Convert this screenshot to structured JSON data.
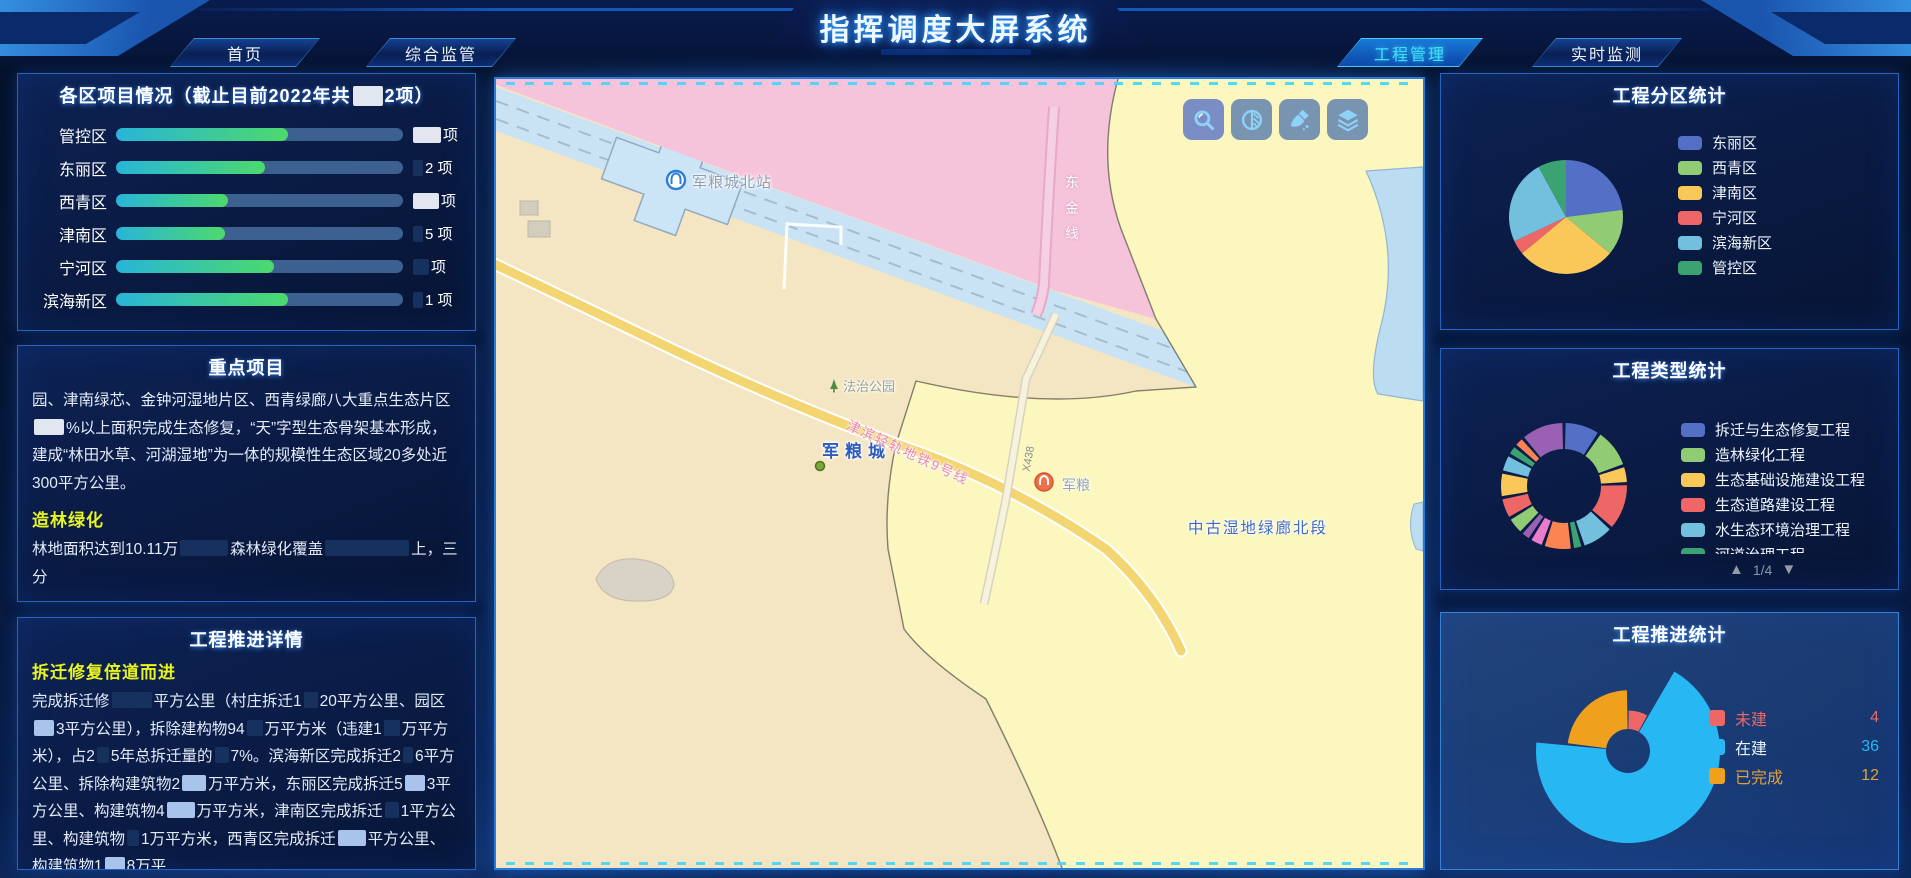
{
  "header": {
    "title": "指挥调度大屏系统",
    "tabs": [
      {
        "label": "首页",
        "active": false
      },
      {
        "label": "综合监管",
        "active": false
      },
      {
        "label": "工程管理",
        "active": true
      },
      {
        "label": "实时监测",
        "active": false
      }
    ]
  },
  "colors": {
    "accent_cyan": "#3fe3ff",
    "subhead_yellow": "#e9f520",
    "bar_gradient_start": "#28b5d8",
    "bar_gradient_end": "#4cd96d",
    "bar_track": "#3c6191",
    "panel_border": "#2a62c0"
  },
  "panels": {
    "district": {
      "title_segments": [
        {
          "t": "各区项目情况（截止目前2022年共"
        },
        {
          "r": "light",
          "w": 30
        },
        {
          "t": "2项）"
        }
      ],
      "rows": [
        {
          "label": "管控区",
          "percent": 60,
          "value_segments": [
            {
              "r": "light",
              "w": 28
            },
            {
              "t": "项"
            }
          ]
        },
        {
          "label": "东丽区",
          "percent": 52,
          "value_segments": [
            {
              "r": "dark",
              "w": 10
            },
            {
              "t": "2 项"
            }
          ]
        },
        {
          "label": "西青区",
          "percent": 39,
          "value_segments": [
            {
              "r": "light",
              "w": 26
            },
            {
              "t": "项"
            }
          ]
        },
        {
          "label": "津南区",
          "percent": 38,
          "value_segments": [
            {
              "r": "dark",
              "w": 10
            },
            {
              "t": "5 项"
            }
          ]
        },
        {
          "label": "宁河区",
          "percent": 55,
          "value_segments": [
            {
              "r": "dark",
              "w": 16
            },
            {
              "t": "项"
            }
          ]
        },
        {
          "label": "滨海新区",
          "percent": 60,
          "value_segments": [
            {
              "r": "dark",
              "w": 10
            },
            {
              "t": "1 项"
            }
          ]
        }
      ]
    },
    "key_projects": {
      "title": "重点项目",
      "p1_segments": [
        {
          "t": "园、津南绿芯、金钟河湿地片区、西青绿廊八大重点生态片区"
        },
        {
          "r": "light",
          "w": 30
        },
        {
          "t": "%以上面积完成生态修复，“天”字型生态骨架基本形成，建成“林田水草、河湖湿地”为一体的规模性生态区域20多处近300平方公里。"
        }
      ],
      "subhead": "造林绿化",
      "p2_segments": [
        {
          "t": "林地面积达到10.11万"
        },
        {
          "r": "dark",
          "w": 48
        },
        {
          "t": "森林绿化覆盖"
        },
        {
          "r": "dark",
          "w": 84
        },
        {
          "t": "上，三分"
        }
      ]
    },
    "progress_detail": {
      "title": "工程推进详情",
      "subhead": "拆迁修复倍道而进",
      "p_segments": [
        {
          "t": "完成拆迁修"
        },
        {
          "r": "dark",
          "w": 40
        },
        {
          "t": "平方公里（村庄拆迁1"
        },
        {
          "r": "dark",
          "w": 14
        },
        {
          "t": "20平方公里、园区"
        },
        {
          "r": "mid",
          "w": 20
        },
        {
          "t": "3平方公里），拆除建构物94"
        },
        {
          "r": "dark",
          "w": 16
        },
        {
          "t": "万平方米（违建1"
        },
        {
          "r": "dark",
          "w": 16
        },
        {
          "t": "万平方米），占2"
        },
        {
          "r": "dark",
          "w": 12
        },
        {
          "t": "5年总拆迁量的"
        },
        {
          "r": "dark",
          "w": 14
        },
        {
          "t": "7%。滨海新区完成拆迁2"
        },
        {
          "r": "dark",
          "w": 10
        },
        {
          "t": "6平方公里、拆除构建筑物2"
        },
        {
          "r": "mid",
          "w": 24
        },
        {
          "t": "万平方米，东丽区完成拆迁5"
        },
        {
          "r": "mid",
          "w": 20
        },
        {
          "t": "3平方公里、构建筑物4"
        },
        {
          "r": "mid",
          "w": 28
        },
        {
          "t": "万平方米，津南区完成拆迁"
        },
        {
          "r": "dark",
          "w": 14
        },
        {
          "t": "1平方公里、构建筑物"
        },
        {
          "r": "dark",
          "w": 12
        },
        {
          "t": "1万平方米，西青区完成拆迁"
        },
        {
          "r": "mid",
          "w": 28
        },
        {
          "t": "平方公里、构建筑物1"
        },
        {
          "r": "mid",
          "w": 20
        },
        {
          "t": "8万平"
        }
      ]
    },
    "zone_stats": {
      "title": "工程分区统计"
    },
    "type_stats": {
      "title": "工程类型统计",
      "pagination": "1/4",
      "page_up_icon": "▲",
      "page_down_icon": "▼"
    },
    "push_stats": {
      "title": "工程推进统计"
    }
  },
  "map": {
    "labels": {
      "station_north": "军粮城北站",
      "park": "法治公园",
      "town": "军粮城",
      "rail_line": "津滨轻轨地铁9号线",
      "road_code": "X438",
      "line_east": "东金线",
      "corridor": "中古湿地绿廊北段",
      "station_right": "军粮"
    },
    "toolbar": [
      {
        "name": "zoom-tool"
      },
      {
        "name": "contrast-tool"
      },
      {
        "name": "clean-tool"
      },
      {
        "name": "layers-tool"
      }
    ],
    "region_colors": {
      "tan": "#f5e6c3",
      "pink": "#f6c4da",
      "rail_band": "#c9e3f5",
      "yellow": "#fbf7be",
      "water": "#bcdcf2",
      "road": "#f3d571"
    }
  },
  "chart_data": [
    {
      "id": "district_bars",
      "type": "bar",
      "title": "各区项目情况（截止目前2022年共█2项）",
      "categories": [
        "管控区",
        "东丽区",
        "西青区",
        "津南区",
        "宁河区",
        "滨海新区"
      ],
      "fill_percent": [
        60,
        52,
        39,
        38,
        55,
        60
      ],
      "values_visible": [
        "",
        "2",
        "",
        "5",
        "",
        "1"
      ],
      "unit": "项"
    },
    {
      "id": "zone_pie",
      "type": "pie",
      "title": "工程分区统计",
      "categories": [
        "东丽区",
        "西青区",
        "津南区",
        "宁河区",
        "滨海新区",
        "管控区"
      ],
      "values": [
        23,
        13,
        28,
        4,
        24,
        8
      ],
      "colors": [
        "#5470c6",
        "#91cc75",
        "#fac858",
        "#ee6666",
        "#73c0de",
        "#3ba272"
      ],
      "legend_position": "right"
    },
    {
      "id": "type_donut",
      "type": "pie",
      "title": "工程类型统计",
      "legend": [
        {
          "label": "拆迁与生态修复工程",
          "color": "#5470c6"
        },
        {
          "label": "造林绿化工程",
          "color": "#91cc75"
        },
        {
          "label": "生态基础设施建设工程",
          "color": "#fac858"
        },
        {
          "label": "生态道路建设工程",
          "color": "#ee6666"
        },
        {
          "label": "水生态环境治理工程",
          "color": "#73c0de"
        },
        {
          "label": "河道治理工程",
          "color": "#3ba272"
        }
      ],
      "segments": [
        {
          "v": 9,
          "c": "#5470c6"
        },
        {
          "v": 10,
          "c": "#91cc75"
        },
        {
          "v": 4,
          "c": "#fac858"
        },
        {
          "v": 12,
          "c": "#ee6666"
        },
        {
          "v": 8,
          "c": "#73c0de"
        },
        {
          "v": 2,
          "c": "#3ba272"
        },
        {
          "v": 7,
          "c": "#fc8452"
        },
        {
          "v": 3,
          "c": "#ea7ccc"
        },
        {
          "v": 2,
          "c": "#9a60b4"
        },
        {
          "v": 4,
          "c": "#91cc75"
        },
        {
          "v": 5,
          "c": "#ee6666"
        },
        {
          "v": 6,
          "c": "#fac858"
        },
        {
          "v": 4,
          "c": "#73c0de"
        },
        {
          "v": 2,
          "c": "#3ba272"
        },
        {
          "v": 2,
          "c": "#fc8452"
        },
        {
          "v": 11,
          "c": "#9a60b4"
        }
      ],
      "pagination": "1/4"
    },
    {
      "id": "push_rose",
      "type": "pie",
      "title": "工程推进统计",
      "series": [
        {
          "name": "未建",
          "value": 4,
          "color": "#ee6666",
          "radius": 0.44,
          "text_color": "#e56a6a"
        },
        {
          "name": "在建",
          "value": 36,
          "color": "#27b7f3",
          "radius": 1.0,
          "text_color": "#e8f4ff",
          "value_color": "#29b8f2"
        },
        {
          "name": "已完成",
          "value": 12,
          "color": "#efa11e",
          "radius": 0.66,
          "text_color": "#e0a23c"
        }
      ]
    }
  ]
}
